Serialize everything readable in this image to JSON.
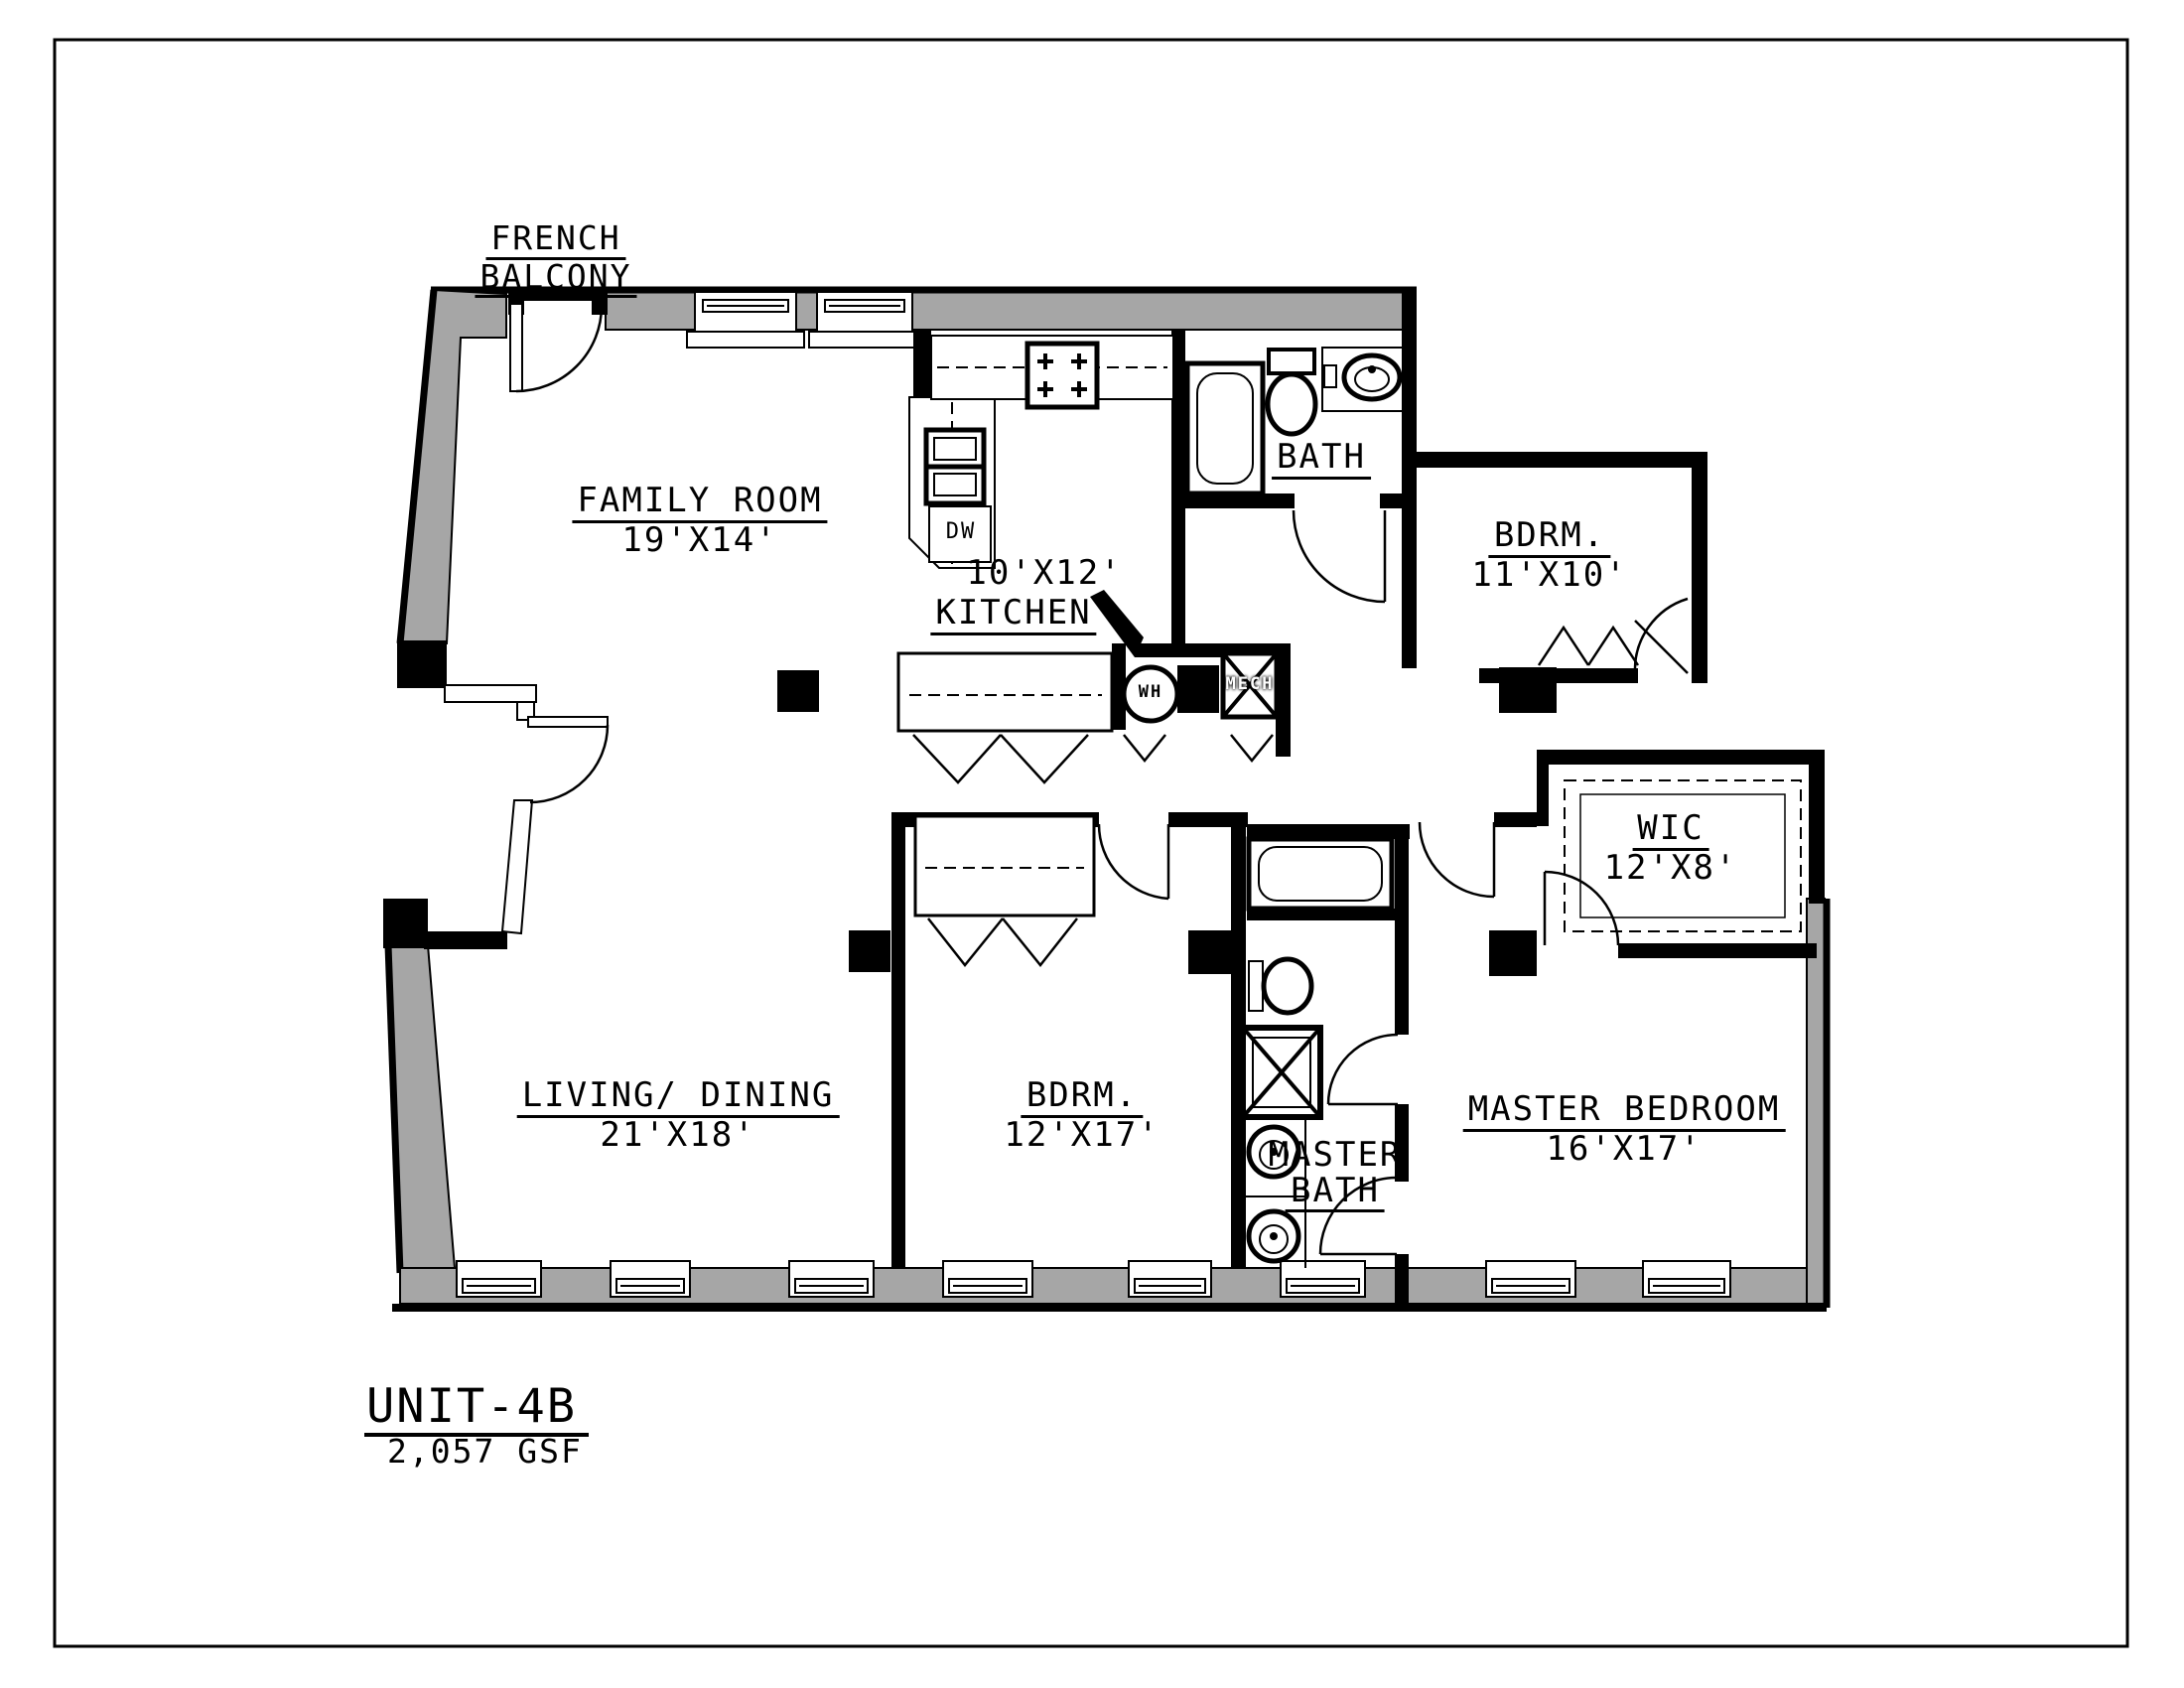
{
  "drawing": {
    "unit_title": "UNIT-4B",
    "unit_area": "2,057 GSF",
    "balcony_label": [
      "FRENCH",
      "BALCONY"
    ],
    "rooms": {
      "family_room": {
        "name": "FAMILY ROOM",
        "dims": "19'X14'"
      },
      "kitchen": {
        "name": "KITCHEN",
        "dims": "10'X12'"
      },
      "bath": {
        "name": "BATH"
      },
      "bedroom_upper": {
        "name": "BDRM.",
        "dims": "11'X10'"
      },
      "wic": {
        "name": "WIC",
        "dims": "12'X8'"
      },
      "living_dining": {
        "name": "LIVING/ DINING",
        "dims": "21'X18'"
      },
      "bedroom_lower": {
        "name": "BDRM.",
        "dims": "12'X17'"
      },
      "master_bath": {
        "name_line1": "MASTER",
        "name_line2": "BATH"
      },
      "master_bedroom": {
        "name": "MASTER BEDROOM",
        "dims": "16'X17'"
      }
    },
    "fixture_labels": {
      "water_heater": "WH",
      "mechanical": "MECH",
      "dishwasher": "DW"
    },
    "colors": {
      "wall_fill": "#a6a6a6",
      "line": "#000000",
      "background": "#ffffff"
    }
  }
}
